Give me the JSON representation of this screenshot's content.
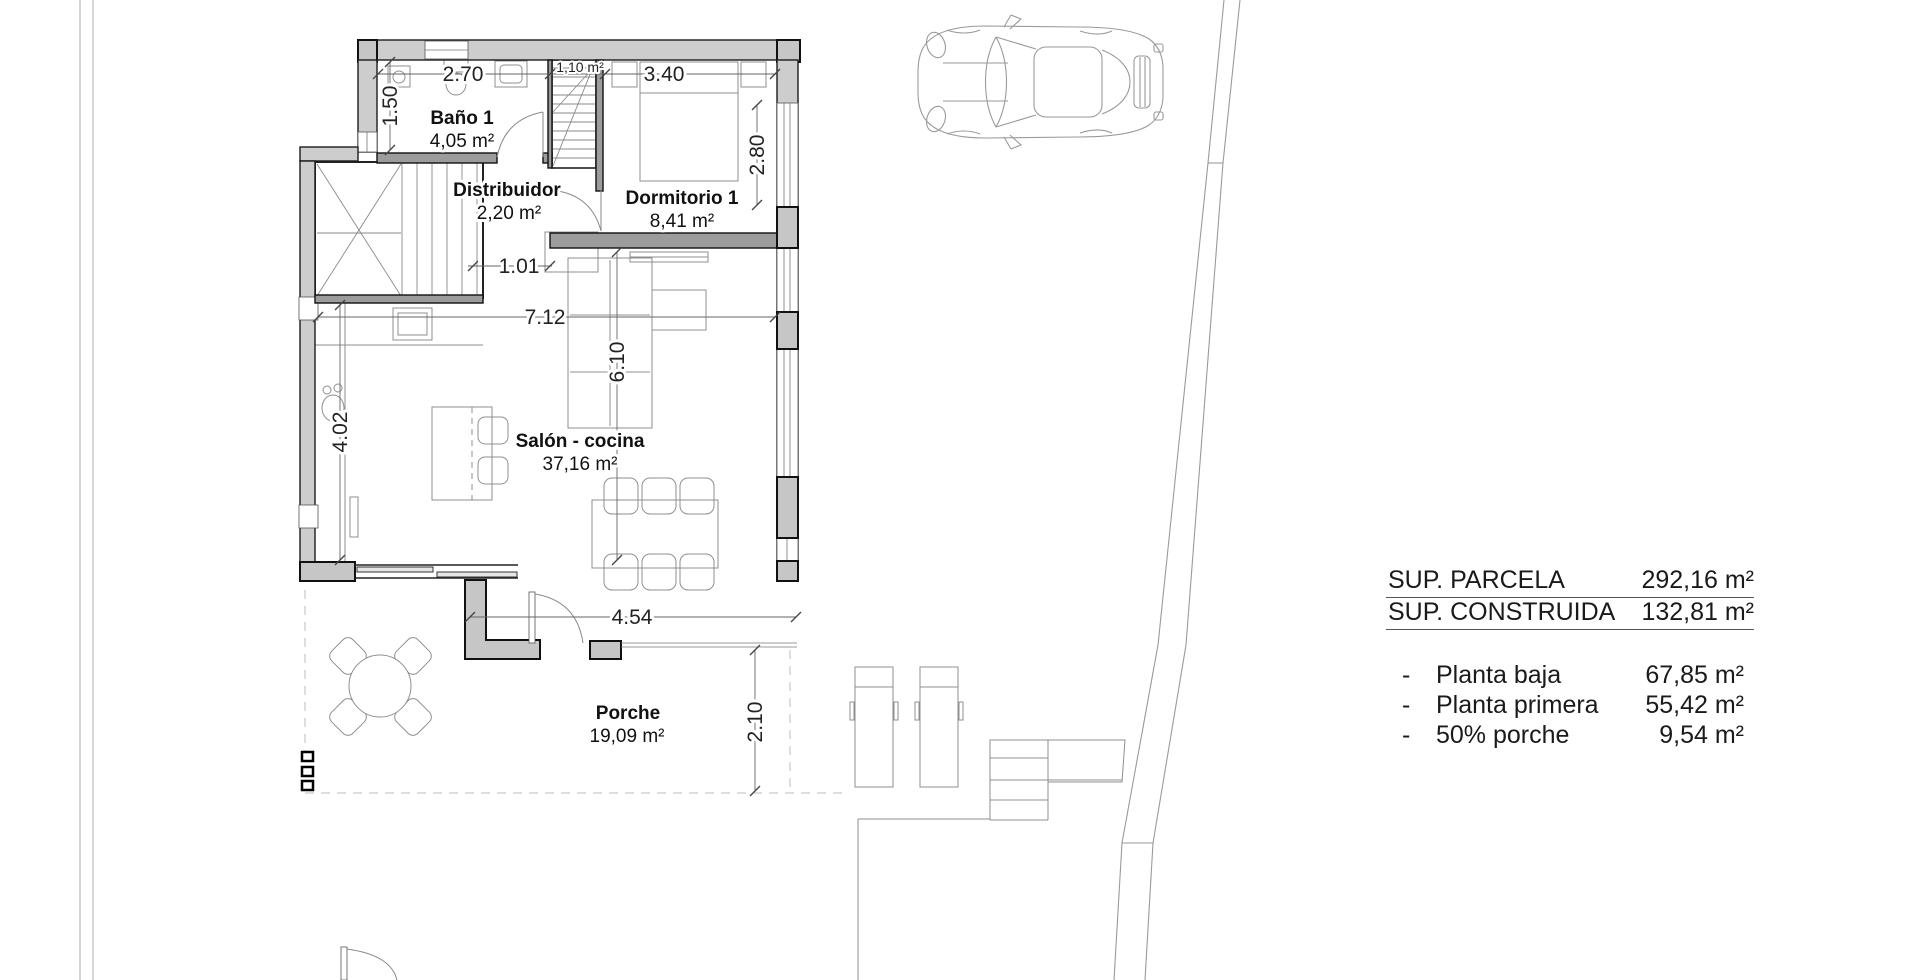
{
  "colors": {
    "background": "#ffffff",
    "wall_fill": "#cdcdcd",
    "interior_wall_fill": "#9c9c9c",
    "wall_stroke": "#111111",
    "drawing_line": "#9a9a9a",
    "text": "#1a1a1a"
  },
  "plan": {
    "rooms": {
      "bano": {
        "name": "Baño 1",
        "area": "4,05 m²"
      },
      "distribuidor": {
        "name": "Distribuidor",
        "area": "2,20 m²"
      },
      "escalera": {
        "area": "1,10 m²"
      },
      "dormitorio": {
        "name": "Dormitorio 1",
        "area": "8,41 m²"
      },
      "salon": {
        "name": "Salón - cocina",
        "area": "37,16 m²"
      },
      "porche": {
        "name": "Porche",
        "area": "19,09 m²"
      }
    },
    "dimensions": {
      "bano_width": "2.70",
      "bano_depth": "1.50",
      "dormitorio_width": "3.40",
      "dormitorio_depth": "2.80",
      "stair_opening": "1.01",
      "salon_width": "7.12",
      "salon_left_depth": "4.02",
      "salon_right_depth": "6.10",
      "porche_width": "4.54",
      "porche_depth": "2.10"
    }
  },
  "summary": {
    "totals": [
      {
        "label": "SUP. PARCELA",
        "value": "292,16 m²"
      },
      {
        "label": "SUP. CONSTRUIDA",
        "value": "132,81 m²"
      }
    ],
    "breakdown": [
      {
        "bullet": "-",
        "label": "Planta baja",
        "value": "67,85 m²"
      },
      {
        "bullet": "-",
        "label": "Planta primera",
        "value": "55,42 m²"
      },
      {
        "bullet": "-",
        "label": "50% porche",
        "value": "9,54 m²"
      }
    ]
  }
}
